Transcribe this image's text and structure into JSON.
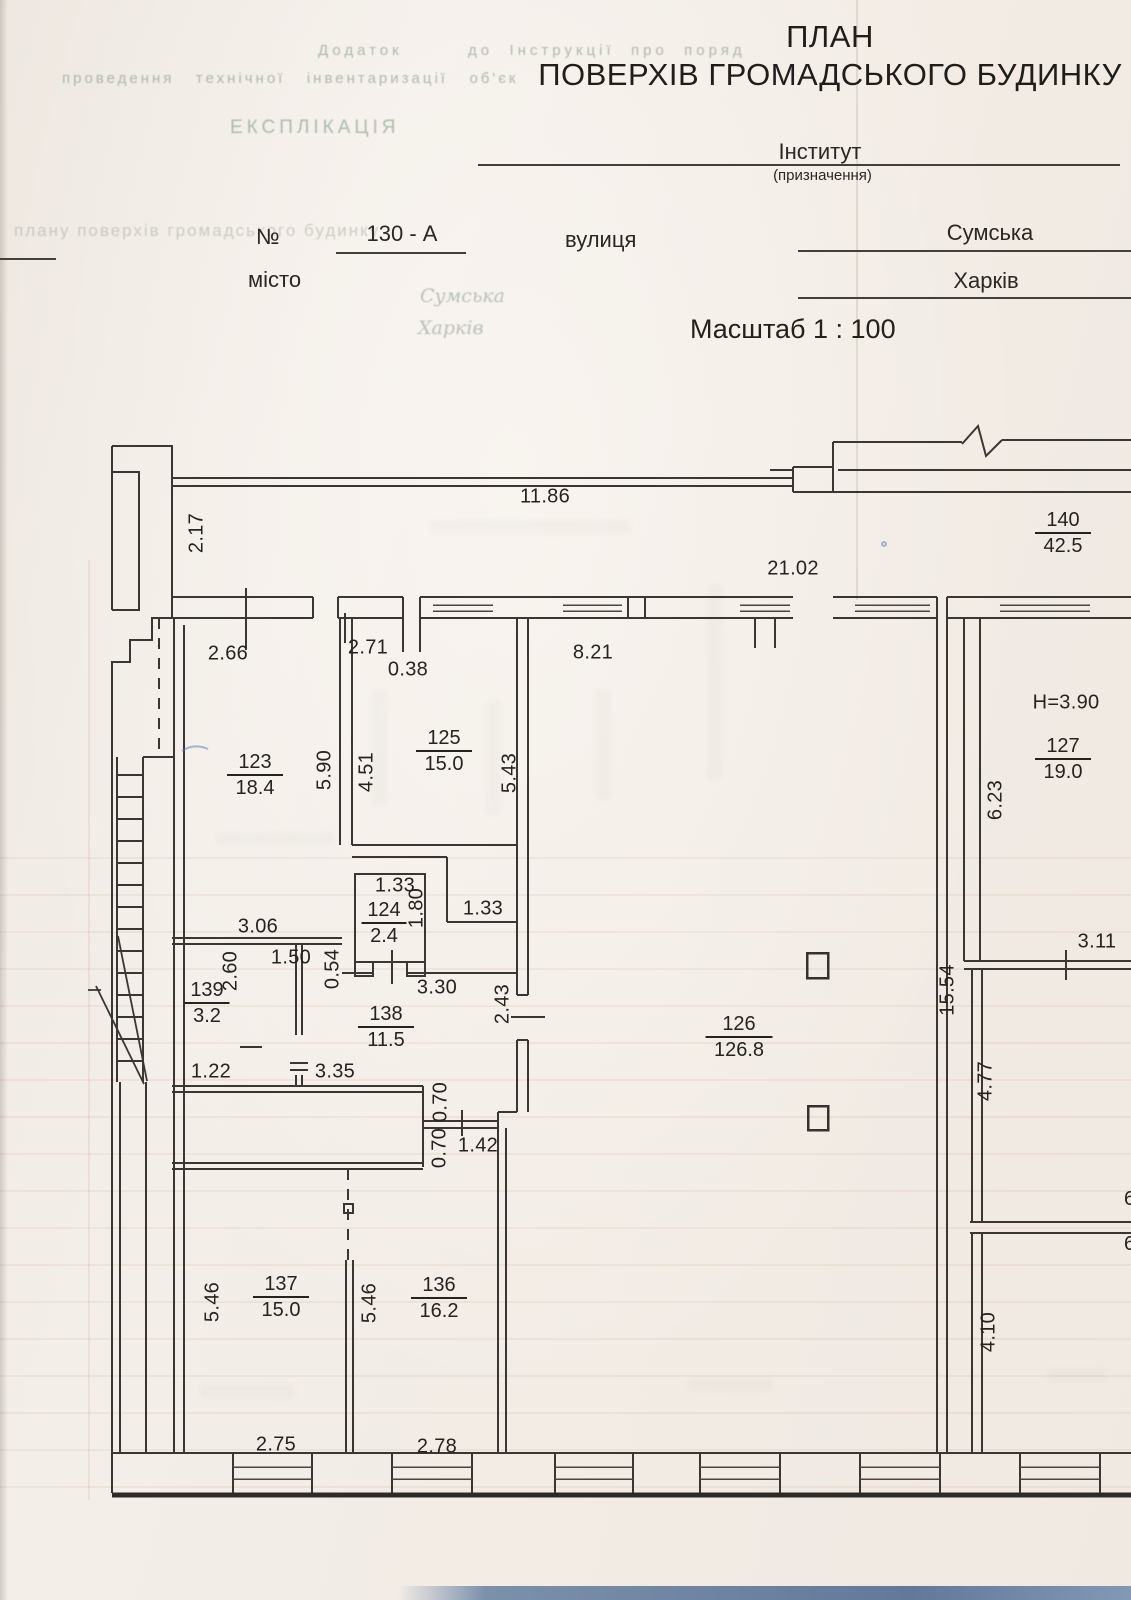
{
  "page": {
    "title_line1": "ПЛАН",
    "title_line2": "ПОВЕРХІВ ГРОМАДСЬКОГО БУДИНКУ",
    "scale": "Масштаб 1 : 100"
  },
  "form": {
    "purpose_value": "Інститут",
    "purpose_caption": "(призначення)",
    "number_label": "№",
    "number_value": "130 - А",
    "street_label": "вулиця",
    "street_value": "Сумська",
    "city_label": "місто",
    "city_value": "Харків"
  },
  "ghost_text": {
    "top_line1": "Додаток        до  Інструкції  про  поряд",
    "top_line2": "проведення   технічної   інвентаризації   об'єк",
    "explication": "ЕКСПЛІКАЦІЯ",
    "bleed_row": "плану поверхів громадського будинку",
    "bleed_street": "Сумська",
    "bleed_city": "Харків"
  },
  "plan": {
    "rooms": [
      {
        "number": "140",
        "area": "42.5",
        "x": 1063,
        "y": 533
      },
      {
        "number": "123",
        "area": "18.4",
        "x": 255,
        "y": 775
      },
      {
        "number": "125",
        "area": "15.0",
        "x": 444,
        "y": 751
      },
      {
        "number": "127",
        "area": "19.0",
        "x": 1063,
        "y": 759
      },
      {
        "number": "124",
        "area": "2.4",
        "x": 384,
        "y": 923
      },
      {
        "number": "139",
        "area": "3.2",
        "x": 207,
        "y": 1003
      },
      {
        "number": "138",
        "area": "11.5",
        "x": 386,
        "y": 1027
      },
      {
        "number": "126",
        "area": "126.8",
        "x": 739,
        "y": 1037
      },
      {
        "number": "137",
        "area": "15.0",
        "x": 281,
        "y": 1297
      },
      {
        "number": "136",
        "area": "16.2",
        "x": 439,
        "y": 1298
      }
    ],
    "dims": [
      {
        "text": "11.86",
        "x": 545,
        "y": 497
      },
      {
        "text": "2.17",
        "x": 197,
        "y": 533,
        "rot": true
      },
      {
        "text": "21.02",
        "x": 793,
        "y": 569
      },
      {
        "text": "2.66",
        "x": 228,
        "y": 654
      },
      {
        "text": "2.71",
        "x": 368,
        "y": 648
      },
      {
        "text": "0.38",
        "x": 408,
        "y": 670
      },
      {
        "text": "8.21",
        "x": 593,
        "y": 653
      },
      {
        "text": "H=3.90",
        "x": 1066,
        "y": 703
      },
      {
        "text": "5.90",
        "x": 325,
        "y": 770,
        "rot": true
      },
      {
        "text": "4.51",
        "x": 367,
        "y": 772,
        "rot": true
      },
      {
        "text": "5.43",
        "x": 510,
        "y": 773,
        "rot": true
      },
      {
        "text": "6.23",
        "x": 996,
        "y": 800,
        "rot": true
      },
      {
        "text": "1.33",
        "x": 395,
        "y": 886
      },
      {
        "text": "1.80",
        "x": 417,
        "y": 908,
        "rot": true
      },
      {
        "text": "1.33",
        "x": 483,
        "y": 909
      },
      {
        "text": "3.06",
        "x": 258,
        "y": 927
      },
      {
        "text": "1.50",
        "x": 291,
        "y": 958
      },
      {
        "text": "0.54",
        "x": 333,
        "y": 969,
        "rot": true
      },
      {
        "text": "2.60",
        "x": 231,
        "y": 971,
        "rot": true
      },
      {
        "text": "3.30",
        "x": 437,
        "y": 988
      },
      {
        "text": "2.43",
        "x": 503,
        "y": 1004,
        "rot": true
      },
      {
        "text": "15.54",
        "x": 948,
        "y": 990,
        "rot": true
      },
      {
        "text": "3.11",
        "x": 1097,
        "y": 942
      },
      {
        "text": "1.22",
        "x": 211,
        "y": 1072
      },
      {
        "text": "3.35",
        "x": 335,
        "y": 1072
      },
      {
        "text": "0.70",
        "x": 441,
        "y": 1102,
        "rot": true
      },
      {
        "text": "0.70",
        "x": 440,
        "y": 1148,
        "rot": true
      },
      {
        "text": "1.42",
        "x": 478,
        "y": 1146
      },
      {
        "text": "4.77",
        "x": 986,
        "y": 1081,
        "rot": true
      },
      {
        "text": "4.10",
        "x": 989,
        "y": 1332,
        "rot": true
      },
      {
        "text": "5.46",
        "x": 213,
        "y": 1302,
        "rot": true
      },
      {
        "text": "5.46",
        "x": 370,
        "y": 1303,
        "rot": true
      },
      {
        "text": "2.75",
        "x": 276,
        "y": 1445
      },
      {
        "text": "2.78",
        "x": 437,
        "y": 1447
      }
    ],
    "edge_fragments": [
      {
        "text": "6",
        "x": 1124,
        "y": 1188
      },
      {
        "text": "6",
        "x": 1124,
        "y": 1233
      }
    ]
  }
}
